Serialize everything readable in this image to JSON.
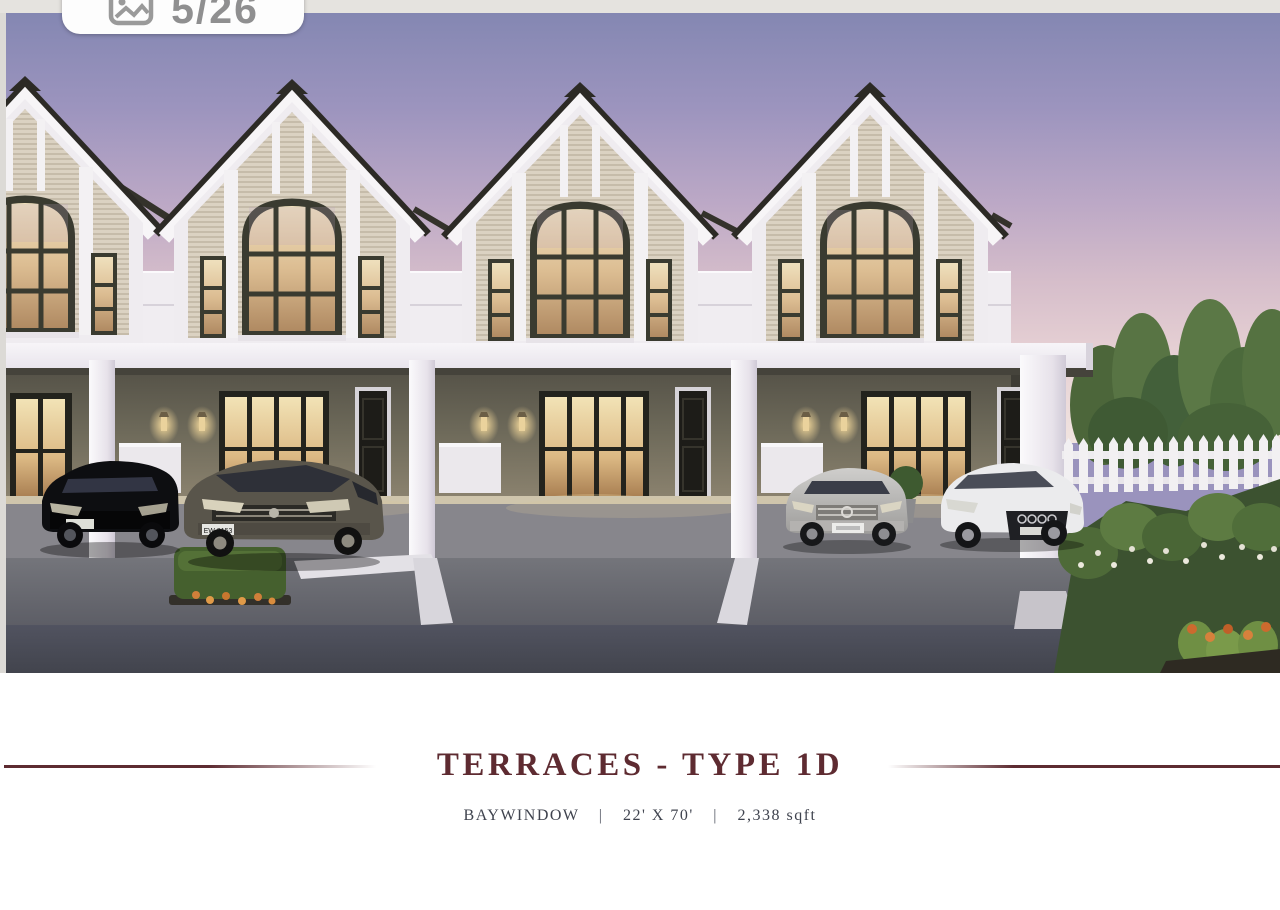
{
  "photo_counter": {
    "display": "5/26",
    "icon": "photos-icon"
  },
  "listing": {
    "title": "TERRACES - TYPE 1D",
    "spec_feature": "BAYWINDOW",
    "spec_dimensions": "22' X 70'",
    "spec_area": "2,338 sqft",
    "separator": "|"
  },
  "scene": {
    "license_plate": "EW 2153",
    "subject": "two-storey terrace houses rendering with four cars, hedge, picket fence and garden at dusk"
  },
  "colors": {
    "title_maroon": "#5e2b31",
    "subtitle_gray": "#3f434e",
    "counter_gray": "#8f8f90",
    "sky_top": "#8487b2",
    "sky_horizon": "#f1e4e0",
    "house_white": "#f3f1f4",
    "roof_dark": "#2c2a25",
    "ground_wall_olive": "#6e6a5a",
    "driveway_gray": "#64656c",
    "road_dark": "#474951"
  }
}
